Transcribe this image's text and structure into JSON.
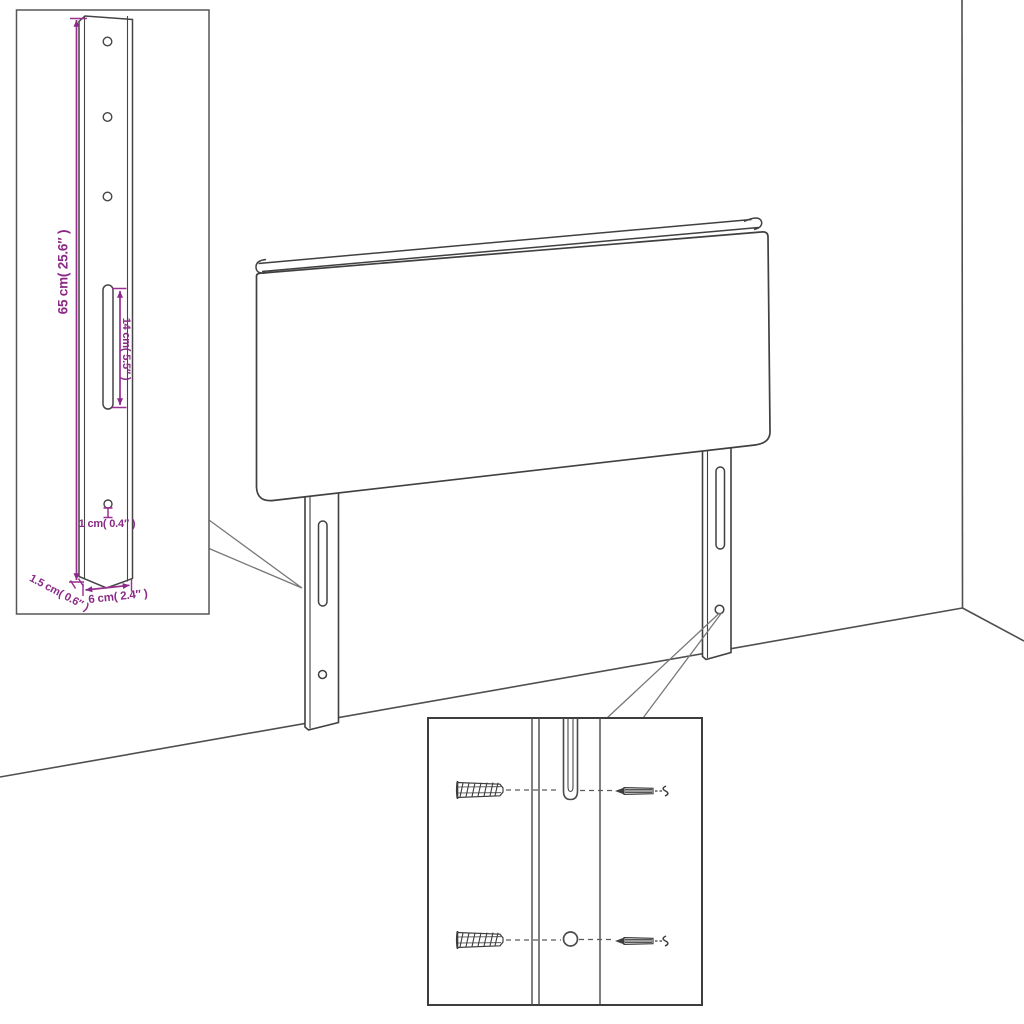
{
  "meta": {
    "title": "Headboard with mounting legs — dimension and hardware diagram",
    "type": "product-assembly-diagram"
  },
  "colors": {
    "line": "#404040",
    "dimension_accent": "#8b2a86",
    "background": "#ffffff"
  },
  "annotations": {
    "leg_height": "65 cm( 25.6″ )",
    "slot_length": "14 cm( 5.5″ )",
    "hole_diameter": "1 cm( 0.4″ )",
    "leg_thickness": "1.5 cm( 0.6″ )",
    "leg_width": "6 cm( 2.4″ )"
  },
  "components": {
    "main_view": [
      "headboard",
      "left-mounting-leg",
      "right-mounting-leg",
      "wall-corner",
      "floor-line"
    ],
    "detail_boxes": [
      {
        "name": "leg-dimension-detail",
        "shows": "mounting leg with three holes, slot and bottom hole"
      },
      {
        "name": "hardware-detail",
        "shows": "two wall plugs and two screws aligned with leg slot and hole"
      }
    ],
    "icons": [
      "wall-plug-icon",
      "screw-icon"
    ]
  }
}
